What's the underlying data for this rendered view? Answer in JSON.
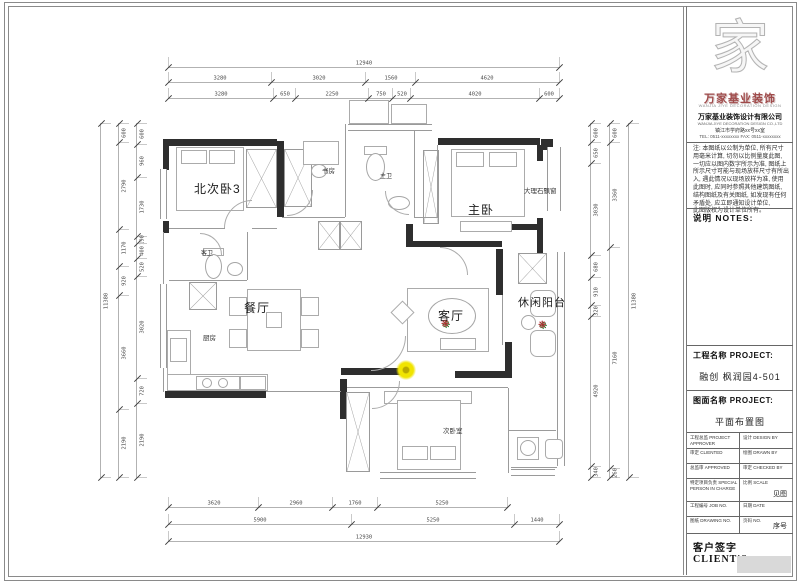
{
  "sheet": {
    "logo": {
      "glyph": "家",
      "wordmark": "万家基业装饰",
      "wordmark_caption": "WANJIA JIYE DECORATION DESIGN",
      "company_name": "万家基业装饰设计有限公司",
      "company_sub": "WANJIA JIYE DECORATION DESIGN CO.,LTD",
      "address": "镇江市学府路xx号xx室",
      "tel": "TEL: 0511-xxxxxxxx   FAX: 0511-xxxxxxxx"
    },
    "notes": {
      "header": "说明  NOTES:",
      "lines": [
        "注: 本图纸以公制为单位, 所有尺寸",
        "用毫米计算, 切勿以比例量度此图,",
        "一切应以图内数字所示为准, 图纸上",
        "所示尺寸可能与现场放样尺寸有所出",
        "入, 遇此情况以现场放样为准, 使用",
        "此图时, 应同时参照其他建筑图纸,",
        "结构图纸及有关图纸, 如发现有任何",
        "矛盾处, 应立即通知设计单位,",
        "此图版权为设计单位所有。"
      ]
    },
    "project": {
      "name_label": "工程名称 PROJECT:",
      "name_value": "融创 枫润园4-501",
      "drawing_label": "图面名称 PROJECT:",
      "drawing_value": "平面布置图"
    },
    "table": {
      "rows": [
        {
          "left": "工程总监 PROJECT APPROVER",
          "right": "设计 DESIGN BY",
          "right_value": ""
        },
        {
          "left": "审定 CLIENTED",
          "right": "绘图 DRAWN BY",
          "right_value": ""
        },
        {
          "left": "总监审 APPROVED",
          "right": "审定 CHECKED BY",
          "right_value": ""
        },
        {
          "left": "特定项目负责 SPECIAL PERSON IN CHARGE",
          "right": "比例 SCALE",
          "right_value": "见图"
        },
        {
          "left": "工程编号 JOB NO.",
          "right": "日期 DATE",
          "right_value": ""
        },
        {
          "left": "图纸 DRAWING NO.",
          "right": "页码 NO.",
          "right_value": "序号"
        }
      ]
    },
    "client_label": "客户签字 CLIENT'S"
  },
  "plan": {
    "rooms": {
      "north_bedroom3": "北次卧3",
      "master_bedroom": "主卧",
      "marble_bay_window": "大理石飘窗",
      "study": "书房",
      "master_bath": "主卫",
      "guest_bath": "客卫",
      "dining": "餐厅",
      "kitchen": "厨房",
      "living": "客厅",
      "leisure_balcony": "休闲阳台",
      "second_bedroom": "次卧室"
    },
    "icons": {
      "plant": "❋"
    },
    "dims": {
      "top": {
        "row1": [
          "12940"
        ],
        "row2": [
          "3280",
          "3020",
          "1560",
          "4620"
        ],
        "row3": [
          "3280",
          "650",
          "2250",
          "750",
          "520",
          "4020",
          "600"
        ]
      },
      "bottom": {
        "row1": [
          "3620",
          "2960",
          "1760",
          "5250"
        ],
        "row2": [
          "5900",
          "5250",
          "1440"
        ],
        "row3": [
          "12930"
        ]
      },
      "left": {
        "col1": [
          "11380"
        ],
        "col2": [
          "600",
          "2790",
          "1170",
          "920",
          "3660",
          "2190"
        ],
        "col3": [
          "600",
          "960",
          "1730",
          "190",
          "400",
          "520",
          "3020",
          "720",
          "2190"
        ]
      },
      "right": {
        "col1": [
          "600",
          "650",
          "3030",
          "680",
          "910",
          "320",
          "4920",
          "340"
        ],
        "col2": [
          "600",
          "3360",
          "7160",
          "260"
        ],
        "col3": [
          "11380"
        ]
      }
    }
  }
}
